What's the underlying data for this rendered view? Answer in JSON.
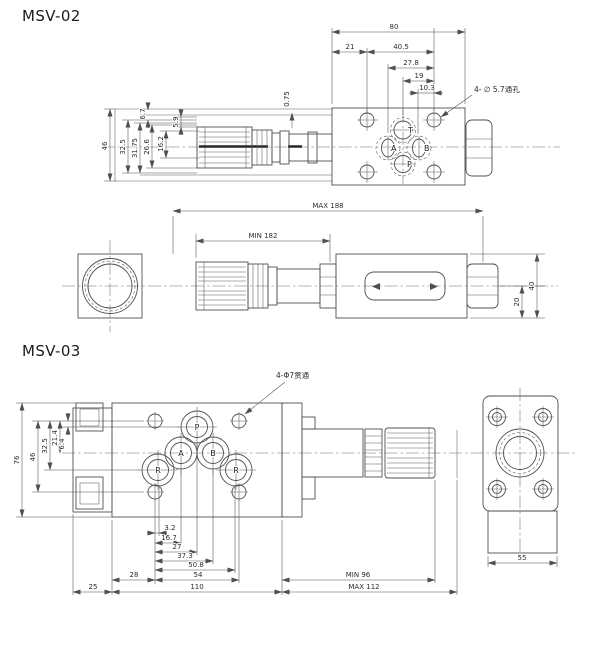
{
  "drawing": {
    "line_color": "#4f4f4f",
    "text_color": "#2c2c2c",
    "background": "#ffffff"
  },
  "msv02": {
    "title": "MSV-02",
    "plate": {
      "hole_note": "4- ∅ 5.7通孔",
      "port_t": "T",
      "port_a": "A",
      "port_b": "B",
      "port_p": "P"
    },
    "dims": {
      "d80": "80",
      "d21": "21",
      "d40_5": "40.5",
      "d27_8": "27.8",
      "d19": "19",
      "d10_3": "10.3",
      "d46": "46",
      "d32_5": "32.5",
      "d31_75": "31.75",
      "d26_6": "26.6",
      "d16_2": "16.2",
      "d5_9": "5.9",
      "d6_7": "6.7",
      "d0_75": "0.75"
    },
    "front": {
      "max_len": "MAX 188",
      "min_len": "MIN 182",
      "d40": "40",
      "d20": "20"
    }
  },
  "msv03": {
    "title": "MSV-03",
    "plate": {
      "hole_note": "4-Φ7贯通",
      "port_p": "P",
      "port_a": "A",
      "port_b": "B",
      "port_r1": "R",
      "port_r2": "R"
    },
    "dims": {
      "d76": "76",
      "d46": "46",
      "d32_5": "32.5",
      "d21_4": "21.4",
      "d6_4": "6.4",
      "d3_2": "3.2",
      "d16_7": "16.7",
      "d27": "27",
      "d37_3": "37.3",
      "d50_8": "50.8",
      "d28": "28",
      "d54": "54",
      "d25": "25",
      "d110": "110",
      "min_len": "MIN 96",
      "max_len": "MAX 112",
      "d55": "55"
    }
  }
}
